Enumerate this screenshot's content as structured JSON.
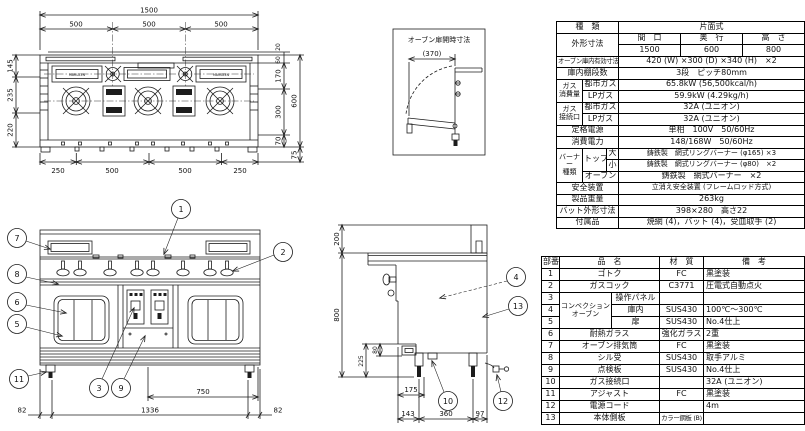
{
  "plan_view": {
    "dim_overall_width": "1500",
    "dims_top": [
      "500",
      "500",
      "500"
    ],
    "dims_left": [
      "145",
      "235",
      "220"
    ],
    "dim_right_20": "20",
    "dim_right_60": "60",
    "dims_right": [
      "170",
      "300",
      "70"
    ],
    "dim_overall_depth": "600",
    "dim_right_75": "75",
    "dims_bottom": [
      "250",
      "500",
      "500",
      "250"
    ],
    "brand": "MARUZEN"
  },
  "oven_door_box": {
    "title": "オーブン扉開時寸法",
    "dim": "(370)"
  },
  "front_view": {
    "callout_1": "1",
    "callout_2": "2",
    "callout_3": "3",
    "callout_5": "5",
    "callout_6": "6",
    "callout_7": "7",
    "callout_8": "8",
    "callout_9": "9",
    "callout_11": "11",
    "dim_left": "82",
    "dim_center": "1336",
    "dim_right": "82",
    "dim_oven_width": "750"
  },
  "side_view": {
    "callout_4": "4",
    "callout_10": "10",
    "callout_12": "12",
    "callout_13": "13",
    "dim_top": "200",
    "dim_height": "800",
    "dim_225": "225",
    "dim_80": "80",
    "dim_175": "175",
    "dim_143": "143",
    "dim_360": "360",
    "dim_97": "97"
  },
  "spec_table": {
    "type_label": "種　類",
    "type_value": "片面式",
    "outer_label": "外形寸法",
    "outer_col_width": "間　口",
    "outer_col_depth": "奥　行",
    "outer_col_height": "高　さ",
    "outer_val_width": "1500",
    "outer_val_depth": "600",
    "outer_val_height": "800",
    "oven_inner_label": "オーブン庫内有効寸法",
    "oven_inner_value": "420 (W) ×300 (D) ×340 (H)　×2",
    "shelf_label": "庫内棚段数",
    "shelf_value": "3段　ピッチ80mm",
    "gas_consumption_label": "ガス\n消費量",
    "gas_city_label": "都市ガス",
    "gas_lp_label": "LPガス",
    "gas_city_value": "65.8kW (56,500kcal/h)",
    "gas_lp_value": "59.9kW (4.29kg/h)",
    "gas_conn_label": "ガス\n接続口",
    "gas_conn_city_label": "都市ガス",
    "gas_conn_lp_label": "LPガス",
    "gas_conn_city_value": "32A (ユニオン)",
    "gas_conn_lp_value": "32A (ユニオン)",
    "power_label": "定格電源",
    "power_value": "単相　100V　50/60Hz",
    "consumption_label": "消費電力",
    "consumption_value": "148/168W　50/60Hz",
    "burner_label": "バーナー\n種類",
    "burner_top_label": "トップ",
    "burner_large_label": "大",
    "burner_small_label": "小",
    "burner_oven_label": "オーブン",
    "burner_large_value": "鋳鉄製　網式リングバーナー (φ165) ×3",
    "burner_small_value": "鋳鉄製　網式リングバーナー (φ80)　×2",
    "burner_oven_value": "鋳鉄製　網式バーナー　×2",
    "safety_label": "安全装置",
    "safety_value": "立消え安全装置 (フレームロッド方式)",
    "weight_label": "製品重量",
    "weight_value": "263kg",
    "pan_label": "バット外形寸法",
    "pan_value": "398×280　高さ22",
    "accessory_label": "付属品",
    "accessory_value": "焼網 (4)，バット (4)，受皿取手 (2)"
  },
  "parts_table": {
    "headers": {
      "no": "部番",
      "name": "品　名",
      "material": "材　質",
      "note": "備　考"
    },
    "conv_group": "コンベクション\nオーブン",
    "rows": [
      {
        "no": "1",
        "name": "ゴトク",
        "material": "FC",
        "note": "黒塗装"
      },
      {
        "no": "2",
        "name": "ガスコック",
        "material": "C3771",
        "note": "圧電式自動点火"
      },
      {
        "no": "3",
        "name": "操作パネル",
        "material": "",
        "note": ""
      },
      {
        "no": "4",
        "name": "庫内",
        "material": "SUS430",
        "note": "100℃～300℃"
      },
      {
        "no": "5",
        "name": "扉",
        "material": "SUS430",
        "note": "No.4仕上"
      },
      {
        "no": "6",
        "name": "耐熱ガラス",
        "material": "強化ガラス",
        "note": "2重"
      },
      {
        "no": "7",
        "name": "オーブン排気筒",
        "material": "FC",
        "note": "黒塗装"
      },
      {
        "no": "8",
        "name": "シル受",
        "material": "SUS430",
        "note": "取手アルミ"
      },
      {
        "no": "9",
        "name": "点検板",
        "material": "SUS430",
        "note": "No.4仕上"
      },
      {
        "no": "10",
        "name": "ガス接続口",
        "material": "",
        "note": "32A (ユニオン)"
      },
      {
        "no": "11",
        "name": "アジャスト",
        "material": "FC",
        "note": "黒塗装"
      },
      {
        "no": "12",
        "name": "電源コード",
        "material": "",
        "note": "4m"
      },
      {
        "no": "13",
        "name": "本体側板",
        "material": "カラー鋼板 (B)",
        "note": ""
      }
    ]
  }
}
